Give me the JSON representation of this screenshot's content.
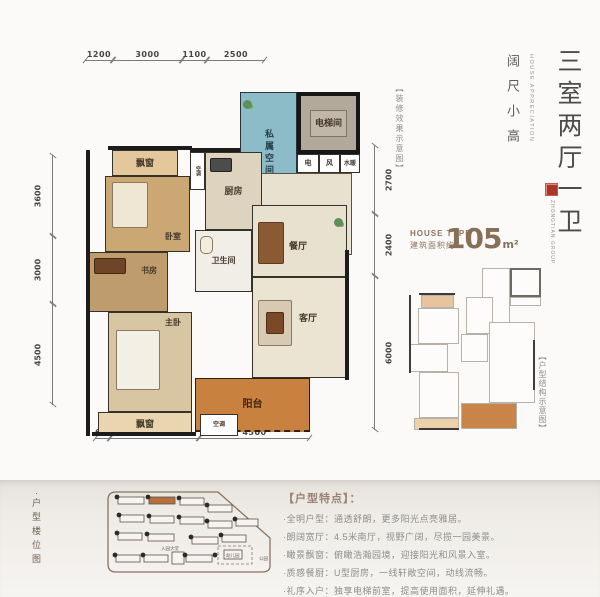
{
  "plan": {
    "dims_top": [
      "1200",
      "3000",
      "1100",
      "2500"
    ],
    "dims_left": [
      "3600",
      "3000",
      "4500"
    ],
    "dims_right": [
      "2700",
      "2400",
      "6000"
    ],
    "dims_bottom": [
      "600",
      "3600",
      "4500"
    ],
    "rooms": {
      "bay_top": "飘窗",
      "bedroom": "卧室",
      "study": "书房",
      "master": "主卧",
      "bay_bottom": "飘窗",
      "ac_top": "空调",
      "ac_bottom": "空调",
      "kitchen": "厨房",
      "bath": "卫生间",
      "dining": "餐厅",
      "living": "客厅",
      "balcony": "阳台",
      "private": "私属空间",
      "elevator": "电梯间",
      "shaft_elec": "电",
      "shaft_vent": "风",
      "shaft_water": "水暖"
    }
  },
  "right_panel": {
    "title_vertical": "三室两厅一卫",
    "subtitle_vertical": "阔尺小高",
    "subtitle_en": "HOUSE APPRECIATION",
    "decor_note": "【装修效果示意图】",
    "brand_en": "ZHONGTIAN GROUP",
    "house_type_label": "HOUSE TYPE",
    "area_label": "建筑面积约",
    "area_value": "105",
    "area_unit": "m²",
    "keyplan_note": "【户型结构示意图】"
  },
  "bottom": {
    "siteplan_bullet": "·",
    "siteplan_title": "户型楼位图",
    "lobby_label": "入园大堂",
    "kindergarten_label": "幼儿园",
    "park_label": "公园",
    "features_title": "【户型特点】：",
    "features": [
      "·全明户型：通透舒朗，更多阳光点亮雅居。",
      "·朗阔宽厅：4.5米南厅，视野广阔，尽揽一园美景。",
      "·瞰景飘窗：俯瞰浩瀚园境，迎接阳光和风景入室。",
      "·质感餐厨：U型厨房，一线轩敞空间，动线流畅。",
      "·礼序入户：独享电梯前室，提高使用面积，延伸礼遇。"
    ]
  },
  "colors": {
    "accent_orange": "#c9813f",
    "corridor_blue": "#8dbcc9",
    "brand_red": "#a8372a",
    "area_brown": "#876f58"
  }
}
